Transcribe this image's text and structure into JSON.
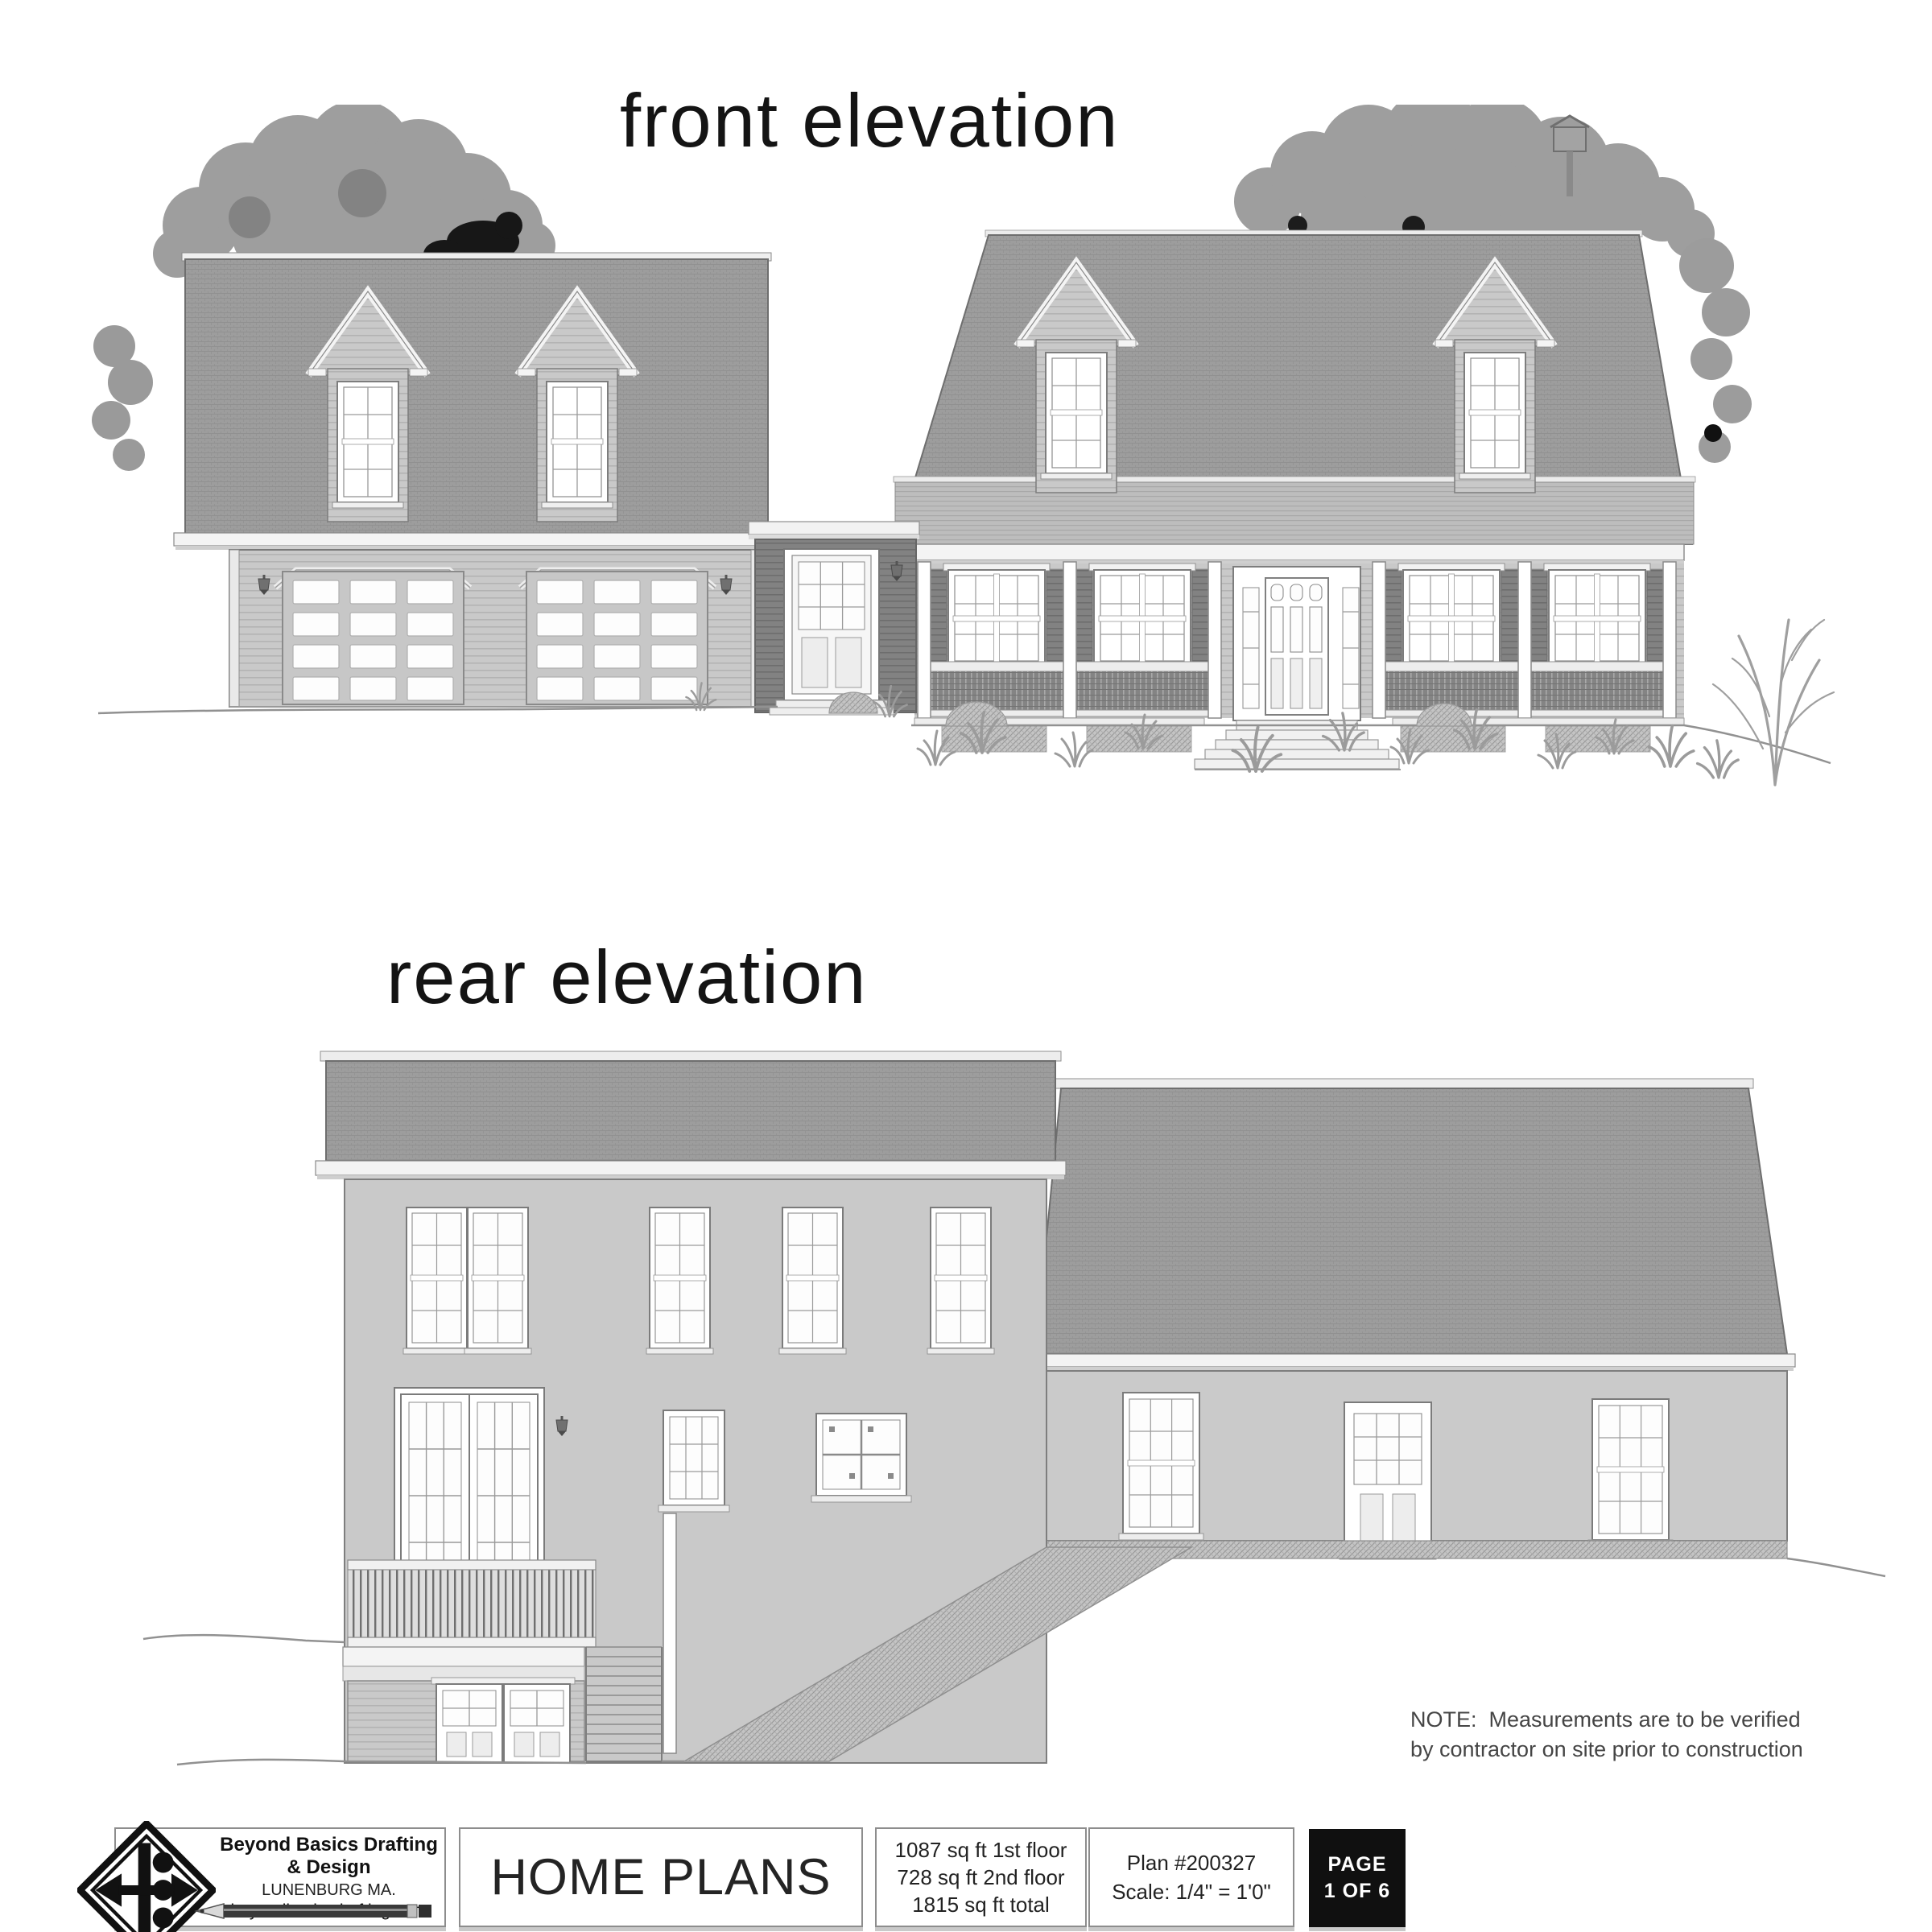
{
  "page": {
    "front_elevation_title": "front elevation",
    "rear_elevation_title": "rear elevation",
    "note": {
      "line1": "NOTE:  Measurements are to be verified",
      "line2": "by contractor on site prior to construction"
    }
  },
  "title_block": {
    "company": {
      "name": "Beyond Basics Drafting & Design",
      "location": "LUNENBURG MA.",
      "website": "beyondbasicsdrafting.com"
    },
    "document_title": "HOME PLANS",
    "area_summary": {
      "first_floor": "1087 sq ft 1st floor",
      "second_floor": "728 sq ft 2nd floor",
      "total": "1815 sq ft total"
    },
    "plan_info": {
      "plan_number": "Plan #200327",
      "scale": "Scale: 1/4\" = 1'0\""
    },
    "page_badge": {
      "line1": "PAGE",
      "line2": "1 OF 6"
    }
  },
  "colors": {
    "roof": "#9c9c9c",
    "wall_light": "#c9c9c9",
    "wall_dark": "#858585",
    "trim_white": "#f4f4f4",
    "outline": "#6e6e6e",
    "tree": "#9e9e9e",
    "tree_dark": "#171717",
    "page_badge_bg": "#101010",
    "text": "#1c1c1c"
  }
}
